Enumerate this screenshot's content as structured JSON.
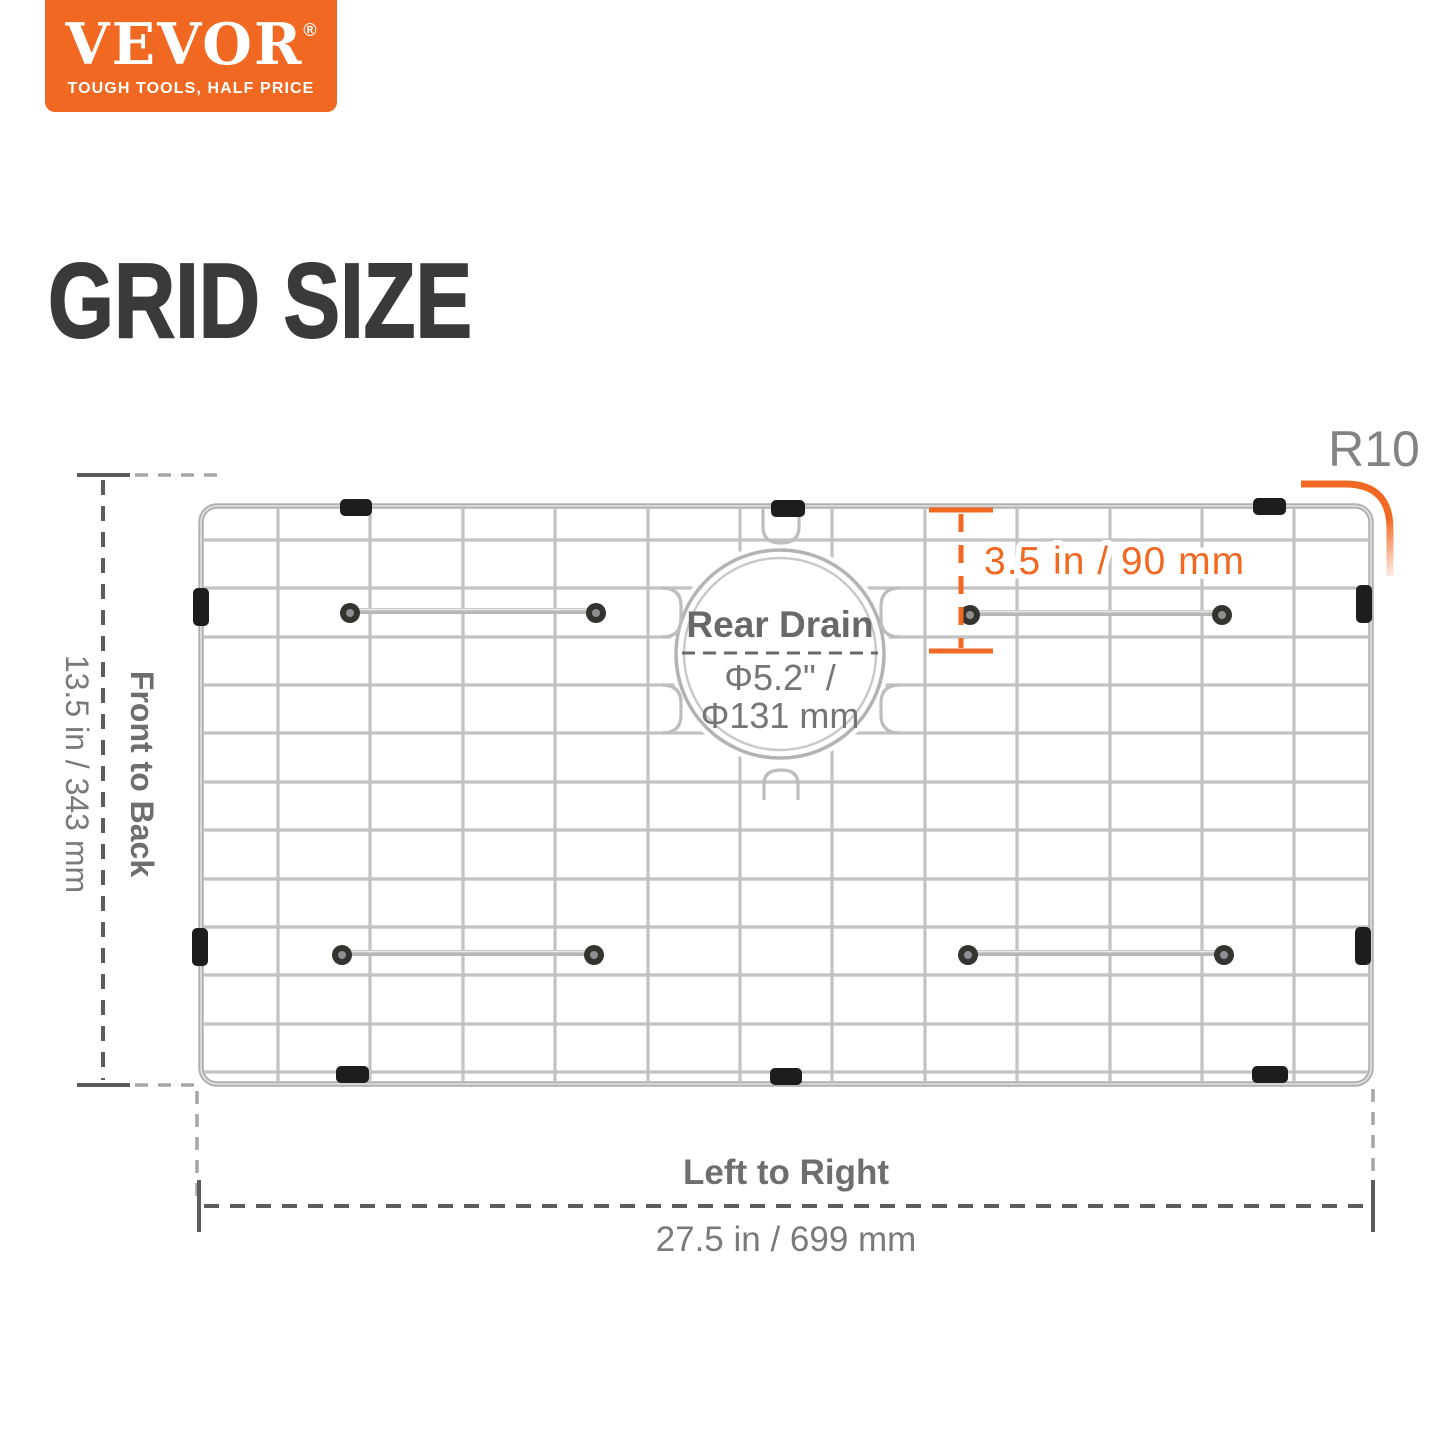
{
  "brand": {
    "name": "VEVOR",
    "registered": "®",
    "tagline": "TOUGH TOOLS, HALF PRICE",
    "color": "#F16822"
  },
  "page": {
    "title": "GRID SIZE"
  },
  "diagram": {
    "corner_radius": "R10",
    "drain_label": "Rear Drain",
    "drain_diameter_line1": "Φ5.2\" /",
    "drain_diameter_line2": "Φ131 mm",
    "offset_dimension": "3.5 in / 90 mm",
    "vertical_dimension": {
      "label": "Front to Back",
      "value": "13.5 in / 343 mm"
    },
    "horizontal_dimension": {
      "label": "Left to Right",
      "value": "27.5 in / 699 mm"
    },
    "colors": {
      "accent": "#F16822",
      "wire": "#c2c2c2",
      "clip": "#1d1d1d",
      "dimension_line": "#5c5c5c",
      "extension_line": "#a6a6a6",
      "label_text": "#6e6e6e",
      "value_text": "#7a7a7a",
      "title_text": "#3a3a3a"
    }
  }
}
